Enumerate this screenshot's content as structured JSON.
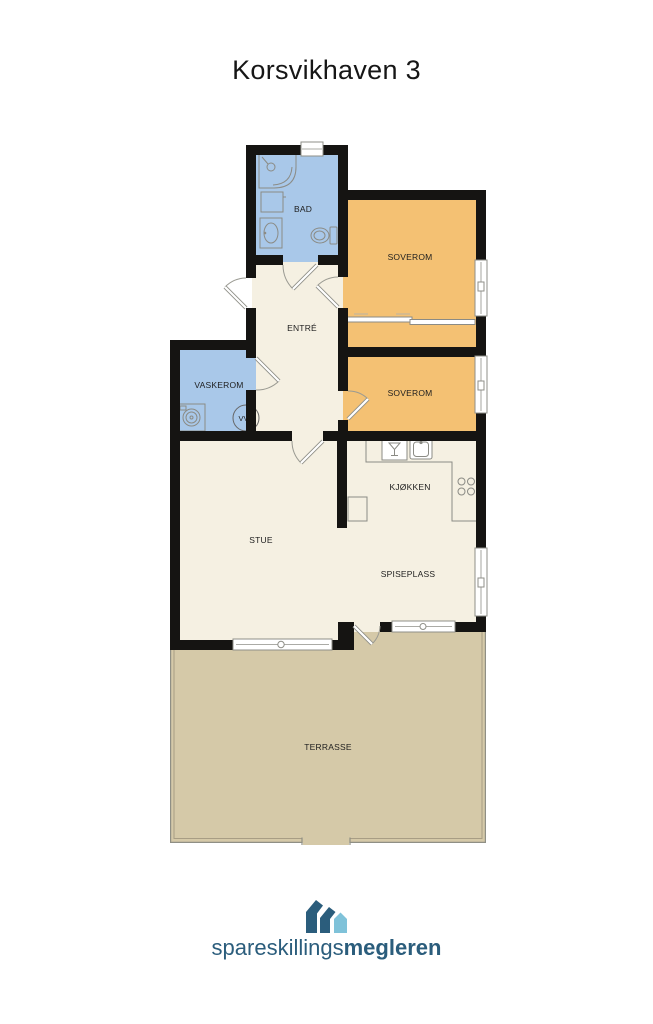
{
  "title": "Korsvikhaven 3",
  "plan": {
    "colors": {
      "wall": "#151412",
      "wet_room": "#a9c8e9",
      "bedroom": "#f4c173",
      "living": "#f5f0e2",
      "terrace": "#d5c9a8"
    },
    "rooms": {
      "bad": "BAD",
      "soverom_1": "SOVEROM",
      "entre": "ENTRÉ",
      "vaskerom": "VASKEROM",
      "soverom_2": "SOVEROM",
      "kjokken": "KJØKKEN",
      "stue": "STUE",
      "spiseplass": "SPISEPLASS",
      "terrasse": "TERRASSE"
    },
    "labels": {
      "water_heater": "VVB"
    }
  },
  "logo": {
    "brand_regular": "spareskillings",
    "brand_bold": "megleren",
    "color_dark": "#2b5d7c",
    "color_light": "#7fc2d9"
  }
}
